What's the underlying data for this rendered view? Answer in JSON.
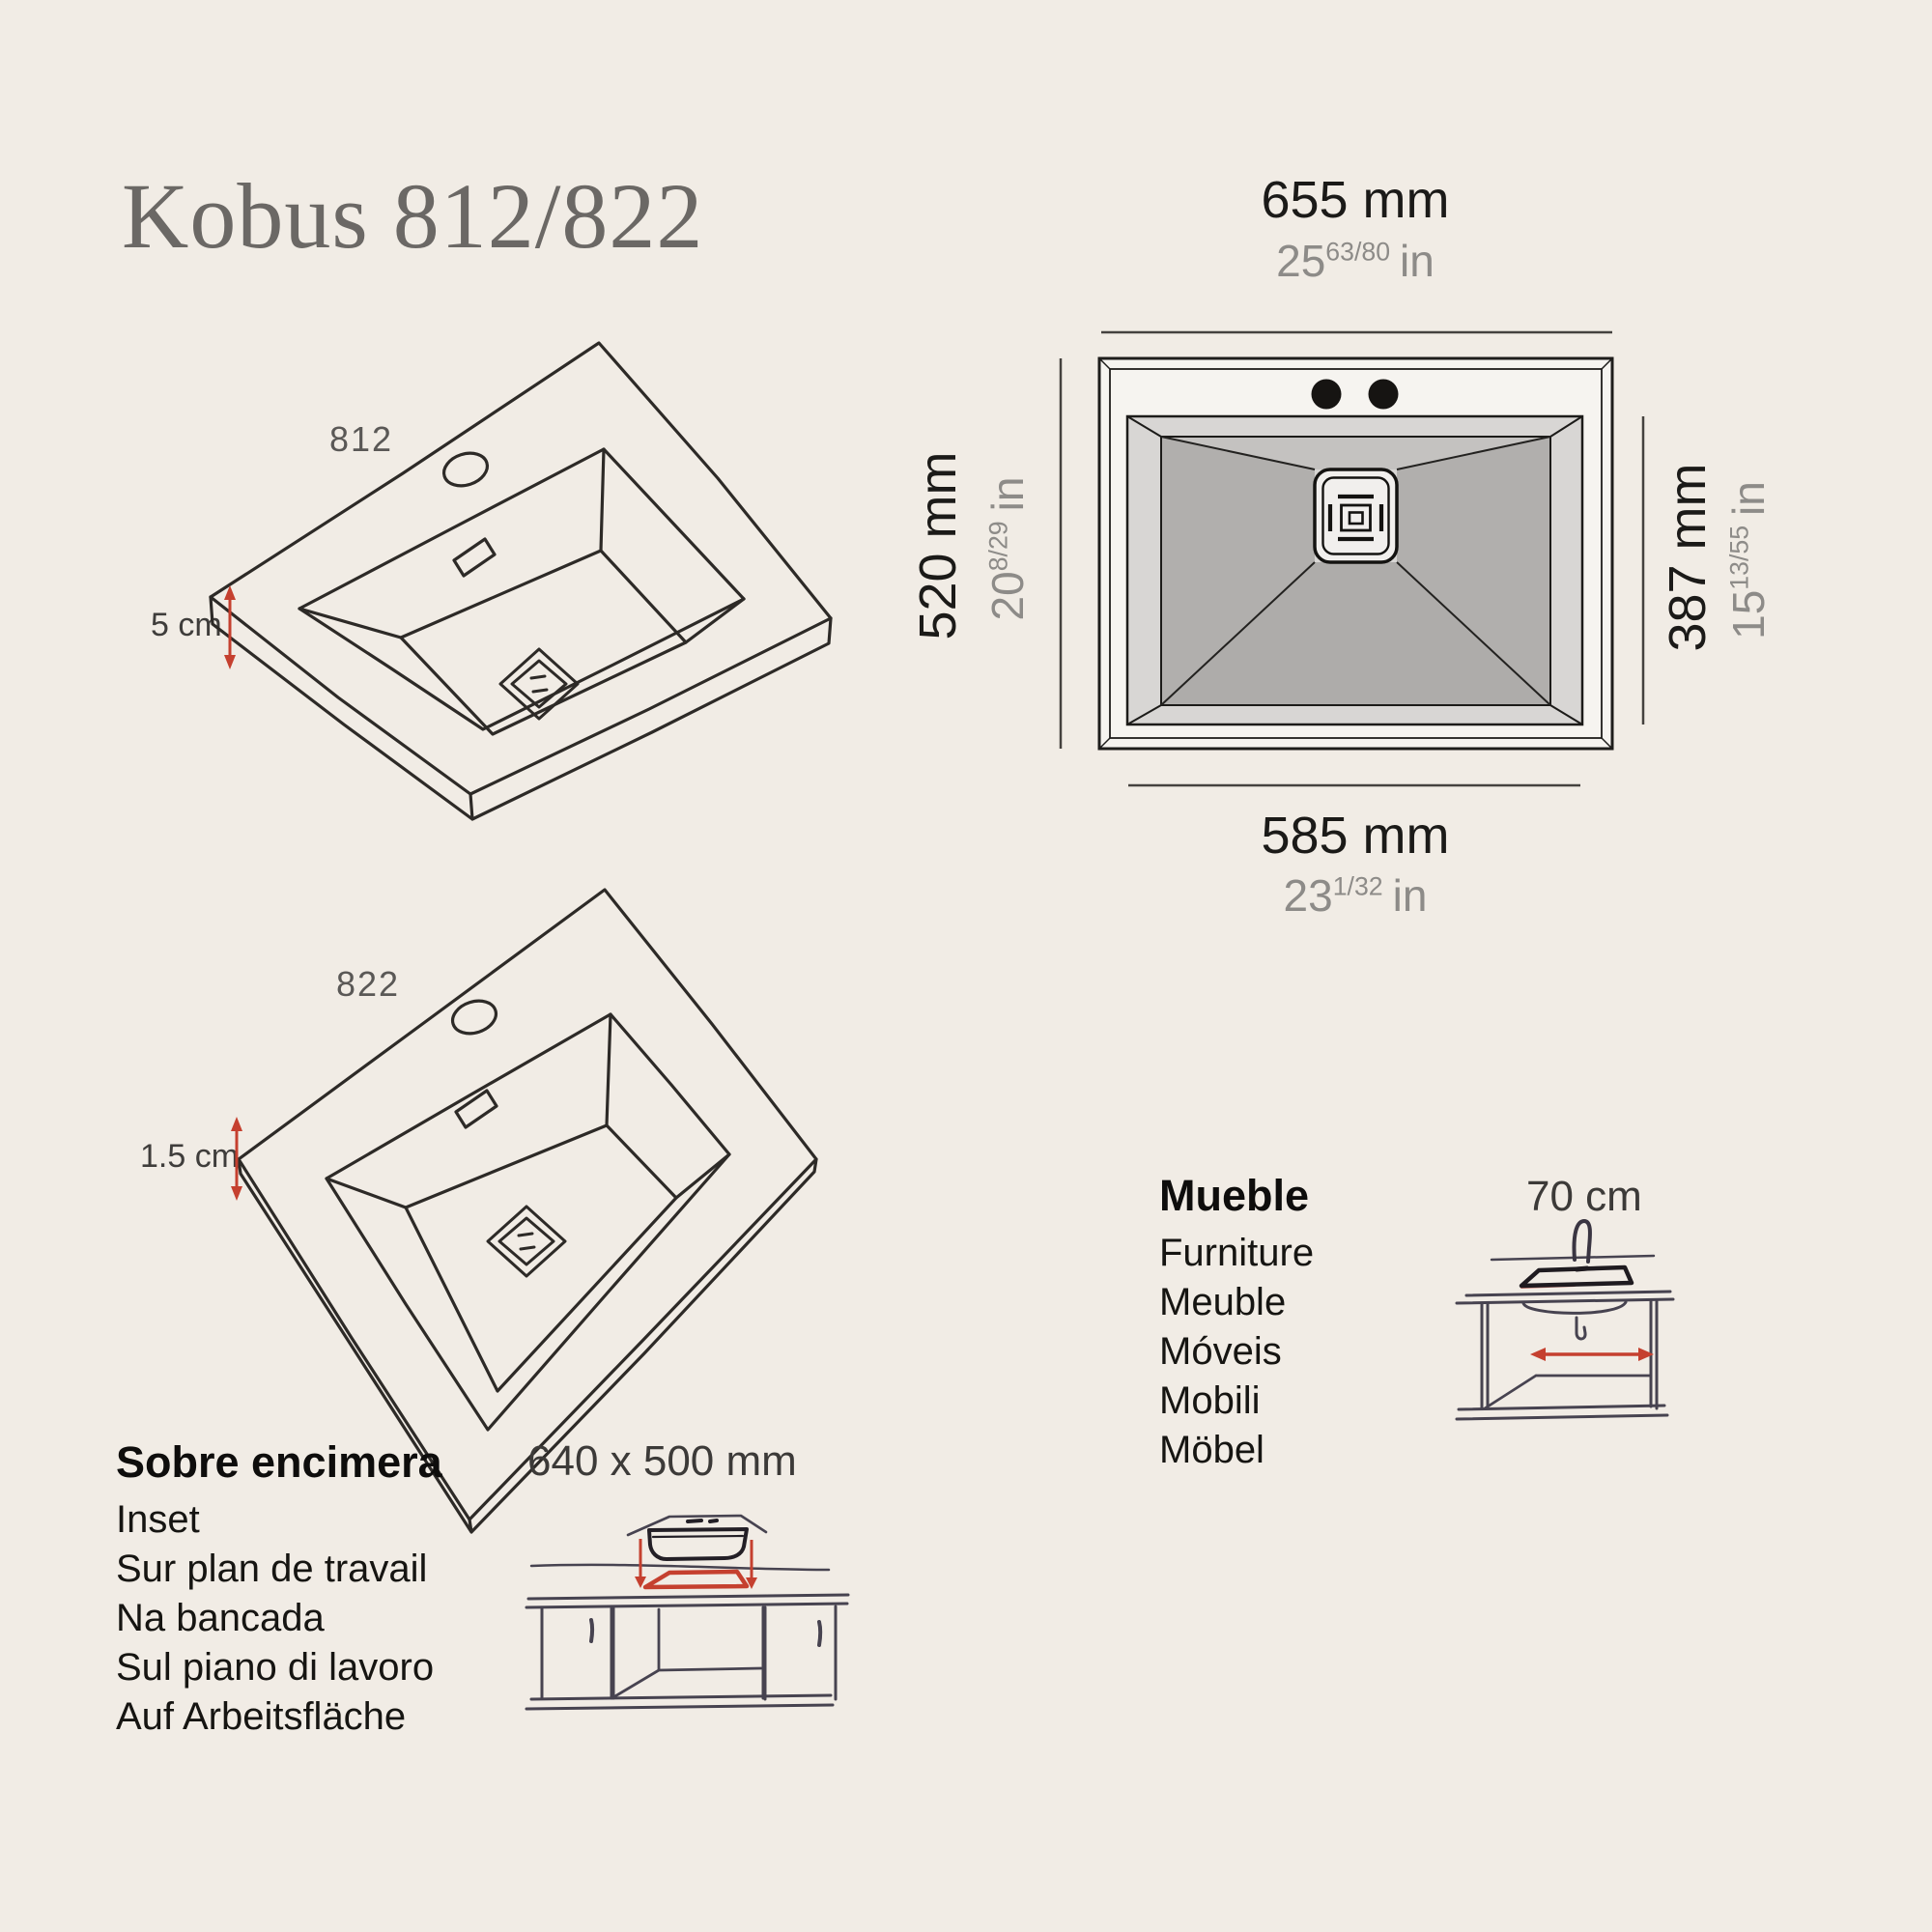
{
  "title": "Kobus 812/822",
  "colors": {
    "background": "#f1ece5",
    "accent_red": "#c5402f",
    "text_dark": "#1b1a18",
    "text_gray": "#8d8b88",
    "title_gray": "#6b6865",
    "sketch_ink": "#2d2a27",
    "cabinet_ink": "#474350",
    "basin_gray": "#b1afad",
    "basin_gray_light": "#c4c2c0",
    "rim_gray": "#d8d6d4"
  },
  "models": {
    "model_812": {
      "label": "812",
      "depth": "5 cm"
    },
    "model_822": {
      "label": "822",
      "depth": "1.5 cm"
    }
  },
  "top_view": {
    "width": {
      "mm": "655 mm",
      "in_whole": "25",
      "in_frac": "63/80",
      "in_unit": "in"
    },
    "height": {
      "mm": "520 mm",
      "in_whole": "20",
      "in_frac": "8/29",
      "in_unit": "in"
    },
    "basin_height": {
      "mm": "387 mm",
      "in_whole": "15",
      "in_frac": "13/55",
      "in_unit": "in"
    },
    "basin_width": {
      "mm": "585 mm",
      "in_whole": "23",
      "in_frac": "1/32",
      "in_unit": "in"
    }
  },
  "furniture": {
    "heading": "Mueble",
    "items": [
      "Furniture",
      "Meuble",
      "Móveis",
      "Mobili",
      "Möbel"
    ],
    "width_label": "70 cm"
  },
  "inset": {
    "heading": "Sobre encimera",
    "items": [
      "Inset",
      "Sur plan de travail",
      "Na bancada",
      "Sul piano di lavoro",
      "Auf Arbeitsfläche"
    ],
    "cutout_label": "640 x 500 mm"
  }
}
